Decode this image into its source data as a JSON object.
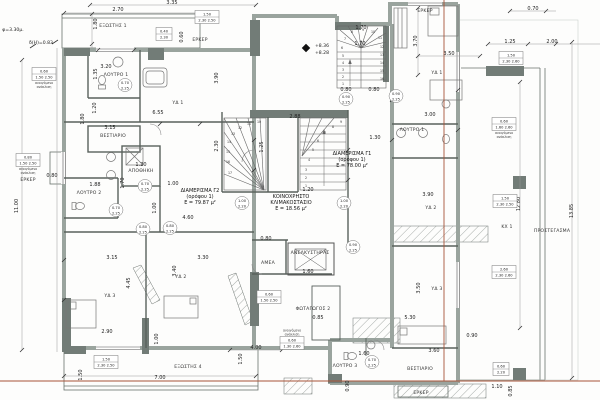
{
  "colors": {
    "wall": "#9aa49e",
    "wall_dark": "#727c77",
    "line": "#4d554f",
    "regulation_line": "#a85438",
    "text": "#222222",
    "background": "#fdfdfc"
  },
  "apartment_labels": [
    {
      "lines": [
        "ΔΙΑΜΕΡΙΣΜΑ Γ2",
        "(ορόφου 1)",
        "Ε = 79.87 μ²"
      ],
      "x": 200,
      "y": 192
    },
    {
      "lines": [
        "ΚΟΙΝΟΧΡΗΣΤΟ",
        "ΚΛΙΜΑΚΟΣΤΑΣΙΟ",
        "Ε = 18.56 μ²"
      ],
      "x": 291,
      "y": 198
    },
    {
      "lines": [
        "ΔΙΑΜΕΡΙΣΜΑ Γ1",
        "(ορόφου 1)",
        "Ε = 78.00 μ²"
      ],
      "x": 352,
      "y": 155
    }
  ],
  "room_labels": [
    {
      "t": "ΕΞΩΣΤΗΣ 1",
      "x": 113,
      "y": 27
    },
    {
      "t": "ΛΟΥΤΡΟ 1",
      "x": 116,
      "y": 76
    },
    {
      "t": "ΥΔ 1",
      "x": 178,
      "y": 104
    },
    {
      "t": "ΒΕΣΤΙΑΡΙΟ",
      "x": 113,
      "y": 137
    },
    {
      "t": "ΑΠΟΘΗΚΗ",
      "x": 141,
      "y": 172
    },
    {
      "t": "ΛΟΥΤΡΟ 2",
      "x": 89,
      "y": 194
    },
    {
      "t": "ΥΔ 3",
      "x": 110,
      "y": 297
    },
    {
      "t": "ΥΔ 2",
      "x": 181,
      "y": 278
    },
    {
      "t": "ΕΞΩΣΤΗΣ 4",
      "x": 188,
      "y": 368
    },
    {
      "t": "ΑΝΕΛΚΥΣΤΗΡΑΣ",
      "x": 310,
      "y": 254
    },
    {
      "t": "ΑΜΕΑ",
      "x": 268,
      "y": 264
    },
    {
      "t": "ΦΩΤΑΓΩΓΟΣ 2",
      "x": 313,
      "y": 310
    },
    {
      "t": "ΛΟΥΤΡΟ 3",
      "x": 345,
      "y": 367
    },
    {
      "t": "ΥΔ 1",
      "x": 437,
      "y": 74
    },
    {
      "t": "ΛΟΥΤΡΟ 1",
      "x": 412,
      "y": 131
    },
    {
      "t": "ΥΔ 2",
      "x": 431,
      "y": 209
    },
    {
      "t": "ΥΔ 3",
      "x": 437,
      "y": 290
    },
    {
      "t": "ΒΕΣΤΙΑΡΙΟ",
      "x": 420,
      "y": 370
    },
    {
      "t": "ΕΡΚΕΡ",
      "x": 200,
      "y": 41
    },
    {
      "t": "ΕΡΚΕΡ",
      "x": 28,
      "y": 181
    },
    {
      "t": "ΕΡΚΕΡ",
      "x": 425,
      "y": 12
    },
    {
      "t": "ΕΡΚΕΡ",
      "x": 421,
      "y": 394
    },
    {
      "t": "ΠΡΟΣΤΕΓΑΣΜΑ",
      "x": 552,
      "y": 232
    },
    {
      "t": "ΚΧ 1",
      "x": 507,
      "y": 228
    }
  ],
  "dim_labels": [
    {
      "t": "3.35",
      "x": 172,
      "y": 4
    },
    {
      "t": "2.70",
      "x": 118,
      "y": 11
    },
    {
      "t": "1.80",
      "x": 97,
      "y": 24,
      "r": -90
    },
    {
      "t": "0.60",
      "x": 183,
      "y": 37,
      "r": -90
    },
    {
      "t": "0.70",
      "x": 533,
      "y": 10
    },
    {
      "t": "1.25",
      "x": 510,
      "y": 43
    },
    {
      "t": "2.00",
      "x": 552,
      "y": 43
    },
    {
      "t": "3.70",
      "x": 417,
      "y": 41,
      "r": -90
    },
    {
      "t": "3.50",
      "x": 449,
      "y": 55
    },
    {
      "t": "3.20",
      "x": 106,
      "y": 68
    },
    {
      "t": "1.35",
      "x": 97,
      "y": 74,
      "r": -90
    },
    {
      "t": "6.55",
      "x": 158,
      "y": 114
    },
    {
      "t": "3.15",
      "x": 110,
      "y": 129
    },
    {
      "t": "1.20",
      "x": 96,
      "y": 108,
      "r": -90
    },
    {
      "t": "1.80",
      "x": 84,
      "y": 119,
      "r": -90
    },
    {
      "t": "2.88",
      "x": 295,
      "y": 118
    },
    {
      "t": "3.90",
      "x": 218,
      "y": 78,
      "r": -90
    },
    {
      "t": "1.70",
      "x": 361,
      "y": 29
    },
    {
      "t": "1.70",
      "x": 360,
      "y": 45
    },
    {
      "t": "0.80",
      "x": 346,
      "y": 91
    },
    {
      "t": "0.80",
      "x": 374,
      "y": 91
    },
    {
      "t": "1.30",
      "x": 375,
      "y": 139
    },
    {
      "t": "1.20",
      "x": 308,
      "y": 191
    },
    {
      "t": "1.25",
      "x": 263,
      "y": 147,
      "r": -90
    },
    {
      "t": "2.30",
      "x": 218,
      "y": 146,
      "r": -90
    },
    {
      "t": "0.80",
      "x": 52,
      "y": 177
    },
    {
      "t": "1.88",
      "x": 95,
      "y": 186
    },
    {
      "t": "1.20",
      "x": 141,
      "y": 166
    },
    {
      "t": "1.70",
      "x": 124,
      "y": 183,
      "r": -90
    },
    {
      "t": "1.00",
      "x": 156,
      "y": 208,
      "r": -90
    },
    {
      "t": "1.00",
      "x": 173,
      "y": 185
    },
    {
      "t": "4.60",
      "x": 188,
      "y": 219
    },
    {
      "t": "3.15",
      "x": 112,
      "y": 259
    },
    {
      "t": "3.30",
      "x": 203,
      "y": 259
    },
    {
      "t": "3.40",
      "x": 176,
      "y": 271,
      "r": -90
    },
    {
      "t": "4.45",
      "x": 130,
      "y": 283,
      "r": -90
    },
    {
      "t": "2.90",
      "x": 107,
      "y": 333
    },
    {
      "t": "1.00",
      "x": 158,
      "y": 339,
      "r": -90
    },
    {
      "t": "1.50",
      "x": 82,
      "y": 375,
      "r": -90
    },
    {
      "t": "7.00",
      "x": 160,
      "y": 379
    },
    {
      "t": "4.00",
      "x": 256,
      "y": 349
    },
    {
      "t": "1.50",
      "x": 242,
      "y": 359,
      "r": -90
    },
    {
      "t": "0.80",
      "x": 266,
      "y": 240
    },
    {
      "t": "1.60",
      "x": 308,
      "y": 273
    },
    {
      "t": "0.85",
      "x": 318,
      "y": 319
    },
    {
      "t": "1.60",
      "x": 364,
      "y": 355
    },
    {
      "t": "0.90",
      "x": 349,
      "y": 386,
      "r": -90
    },
    {
      "t": "3.90",
      "x": 428,
      "y": 196
    },
    {
      "t": "3.00",
      "x": 430,
      "y": 116
    },
    {
      "t": "3.50",
      "x": 420,
      "y": 288,
      "r": -90
    },
    {
      "t": "5.30",
      "x": 410,
      "y": 319
    },
    {
      "t": "0.90",
      "x": 472,
      "y": 337
    },
    {
      "t": "3.60",
      "x": 434,
      "y": 352
    },
    {
      "t": "1.10",
      "x": 497,
      "y": 388
    },
    {
      "t": "0.85",
      "x": 512,
      "y": 391,
      "r": -90
    },
    {
      "t": "12.80",
      "x": 520,
      "y": 204,
      "r": -90
    },
    {
      "t": "13.85",
      "x": 573,
      "y": 211,
      "r": -90
    },
    {
      "t": "11.00",
      "x": 18,
      "y": 206,
      "r": -90
    }
  ],
  "door_tags": [
    {
      "w": "0.70",
      "h": "2.25",
      "x": 125,
      "y": 85
    },
    {
      "w": "0.70",
      "h": "2.25",
      "x": 145,
      "y": 186
    },
    {
      "w": "0.70",
      "h": "2.25",
      "x": 116,
      "y": 210
    },
    {
      "w": "0.80",
      "h": "2.25",
      "x": 143,
      "y": 229
    },
    {
      "w": "0.80",
      "h": "2.25",
      "x": 170,
      "y": 228
    },
    {
      "w": "1.00",
      "h": "2.20",
      "x": 242,
      "y": 203
    },
    {
      "w": "1.00",
      "h": "2.20",
      "x": 344,
      "y": 203
    },
    {
      "w": "0.90",
      "h": "2.25",
      "x": 346,
      "y": 99
    },
    {
      "w": "0.90",
      "h": "2.25",
      "x": 396,
      "y": 96
    },
    {
      "w": "0.90",
      "h": "2.25",
      "x": 353,
      "y": 247
    },
    {
      "w": "0.70",
      "h": "2.25",
      "x": 372,
      "y": 362
    }
  ],
  "window_tags": [
    {
      "rows": [
        "1.50",
        "2.30 2.50"
      ],
      "notes": [],
      "x": 207,
      "y": 17
    },
    {
      "rows": [
        "0.60",
        "1.50 2.50"
      ],
      "notes": [
        "ανοιγόμενο",
        "ανάκλιση"
      ],
      "x": 44,
      "y": 74
    },
    {
      "rows": [
        "0.80",
        "1.50 2.50"
      ],
      "notes": [
        "ανοιγόμενο",
        "ανάκλιση"
      ],
      "x": 28,
      "y": 160
    },
    {
      "rows": [
        "1.50",
        "2.30 2.60"
      ],
      "notes": [],
      "x": 511,
      "y": 58
    },
    {
      "rows": [
        "0.60",
        "1.60 2.60"
      ],
      "notes": [
        "ανοιγόμενο",
        "ανάκλιση"
      ],
      "x": 504,
      "y": 124
    },
    {
      "rows": [
        "1.50",
        "2.30 2.50"
      ],
      "notes": [],
      "x": 505,
      "y": 201
    },
    {
      "rows": [
        "0.60",
        "1.50 2.50"
      ],
      "notes": [],
      "x": 269,
      "y": 297
    },
    {
      "rows": [
        "0.60",
        "1.30 2.60"
      ],
      "notes": [
        "ανοιγόμενο",
        "ανάκλιση"
      ],
      "notes_above": true,
      "x": 292,
      "y": 343
    },
    {
      "rows": [
        "1.50",
        "2.30 2.50"
      ],
      "notes": [],
      "x": 106,
      "y": 362
    },
    {
      "rows": [
        "2.60",
        "2.30 2.60"
      ],
      "notes": [],
      "x": 504,
      "y": 272
    },
    {
      "rows": [
        "0.60",
        "2.20"
      ],
      "notes": [],
      "x": 501,
      "y": 369
    },
    {
      "rows": [
        "0.40",
        "2.30"
      ],
      "notes": [],
      "x": 164,
      "y": 34
    }
  ],
  "annotations": [
    {
      "t": "φ=3.30μ.",
      "x": 13,
      "y": 31
    },
    {
      "t": "δ(Η)=0.83",
      "x": 41,
      "y": 44
    },
    {
      "t": "+8.36",
      "x": 322,
      "y": 47
    },
    {
      "t": "+8.28",
      "x": 322,
      "y": 54
    }
  ],
  "stair_numbers": [
    {
      "t": "1",
      "x": 343,
      "y": 85
    },
    {
      "t": "2",
      "x": 343,
      "y": 78
    },
    {
      "t": "3",
      "x": 343,
      "y": 71
    },
    {
      "t": "4",
      "x": 343,
      "y": 64
    },
    {
      "t": "5",
      "x": 343,
      "y": 57
    },
    {
      "t": "6",
      "x": 342,
      "y": 49
    },
    {
      "t": "7",
      "x": 345,
      "y": 40
    },
    {
      "t": "8",
      "x": 352,
      "y": 33
    },
    {
      "t": "9",
      "x": 363,
      "y": 31
    },
    {
      "t": "10",
      "x": 373,
      "y": 33
    },
    {
      "t": "11",
      "x": 380,
      "y": 39
    },
    {
      "t": "12",
      "x": 382,
      "y": 48
    },
    {
      "t": "13",
      "x": 382,
      "y": 56
    },
    {
      "t": "14",
      "x": 382,
      "y": 64
    },
    {
      "t": "15",
      "x": 382,
      "y": 72
    },
    {
      "t": "16",
      "x": 382,
      "y": 80
    },
    {
      "t": "10",
      "x": 259,
      "y": 123
    },
    {
      "t": "11",
      "x": 249,
      "y": 125
    },
    {
      "t": "12",
      "x": 240,
      "y": 129
    },
    {
      "t": "13",
      "x": 233,
      "y": 135
    },
    {
      "t": "14",
      "x": 229,
      "y": 143
    },
    {
      "t": "15",
      "x": 228,
      "y": 153
    },
    {
      "t": "16",
      "x": 228,
      "y": 163
    },
    {
      "t": "17",
      "x": 230,
      "y": 174
    },
    {
      "t": "1",
      "x": 306,
      "y": 187
    },
    {
      "t": "2",
      "x": 306,
      "y": 179
    },
    {
      "t": "3",
      "x": 306,
      "y": 171
    },
    {
      "t": "4",
      "x": 309,
      "y": 161
    },
    {
      "t": "5",
      "x": 313,
      "y": 151
    },
    {
      "t": "6",
      "x": 318,
      "y": 142
    },
    {
      "t": "7",
      "x": 325,
      "y": 134
    },
    {
      "t": "8",
      "x": 333,
      "y": 128
    },
    {
      "t": "9",
      "x": 341,
      "y": 123
    }
  ]
}
